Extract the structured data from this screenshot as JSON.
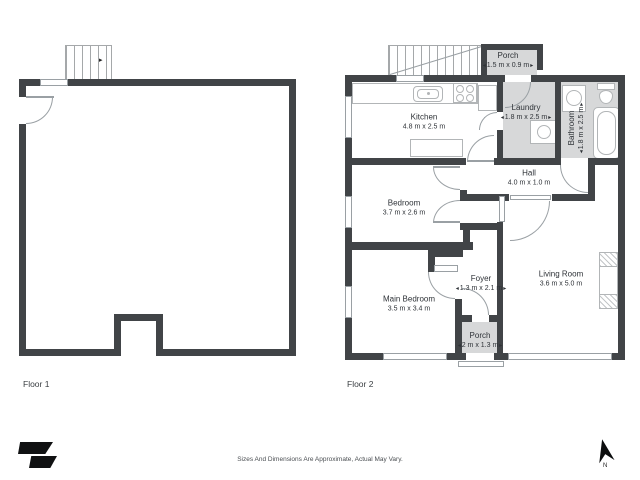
{
  "floor1": {
    "label": "Floor 1"
  },
  "floor2": {
    "label": "Floor 2",
    "rooms": {
      "porch_top": {
        "name": "Porch",
        "dims": "1.5 m x 0.9 m"
      },
      "kitchen": {
        "name": "Kitchen",
        "dims": "4.8 m x 2.5 m"
      },
      "laundry": {
        "name": "Laundry",
        "dims": "1.8 m x 2.5 m"
      },
      "bathroom": {
        "name": "Bathroom",
        "dims": "1.8 m x 2.5 m"
      },
      "hall": {
        "name": "Hall",
        "dims": "4.0 m x 1.0 m"
      },
      "bedroom": {
        "name": "Bedroom",
        "dims": "3.7 m x 2.6 m"
      },
      "main_bedroom": {
        "name": "Main Bedroom",
        "dims": "3.5 m x 3.4 m"
      },
      "foyer": {
        "name": "Foyer",
        "dims": "1.3 m x 2.1 m"
      },
      "living_room": {
        "name": "Living Room",
        "dims": "3.6 m x 5.0 m"
      },
      "porch_bottom": {
        "name": "Porch",
        "dims": "2 m x 1.3 m"
      }
    }
  },
  "footer": {
    "disclaimer": "Sizes And Dimensions Are Approximate, Actual May Vary.",
    "compass_label": "N"
  },
  "icons": {
    "dim_arrow_left": "◂",
    "dim_arrow_right": "▸",
    "stair_direction_arrow": "▸"
  },
  "colors": {
    "wall": "#414447",
    "room_shaded": "#d7d8d9"
  }
}
